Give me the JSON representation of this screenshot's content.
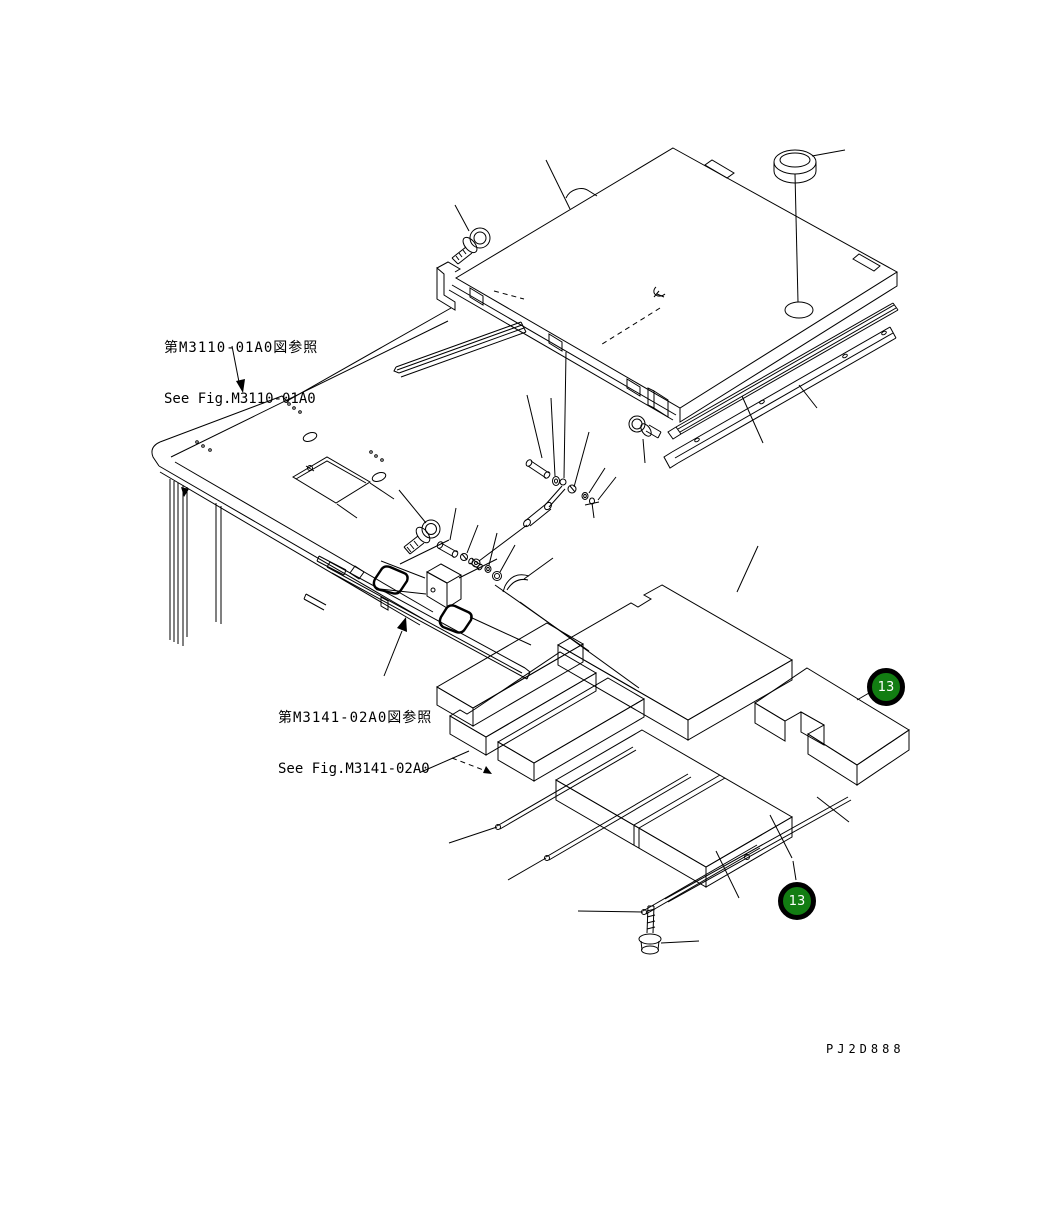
{
  "figure_references": [
    {
      "jp": "第M3110-01A0図参照",
      "en": "See Fig.M3110-01A0"
    },
    {
      "jp": "第M3141-02A0図参照",
      "en": "See Fig.M3141-02A0"
    }
  ],
  "callouts": [
    {
      "number": "13"
    },
    {
      "number": "13"
    }
  ],
  "drawing_code": "PJ2D888",
  "colors": {
    "background": "#ffffff",
    "line": "#000000",
    "callout_fill": "#127d12",
    "callout_ring": "#000000",
    "callout_text": "#ffffff"
  },
  "parts_illustrated": [
    "hood-cover-panel",
    "cap-plug",
    "hinge-blocks",
    "mounting-bolts",
    "gas-spring-damper",
    "pins-washers-clips",
    "side-rails",
    "seal-strip",
    "platform-deck",
    "deck-legs",
    "hatch-cutout",
    "support-rail-with-pads",
    "rubber-pads",
    "bracket-block",
    "floor-mat-panels",
    "mat-retainer-rods",
    "weld-stud-bolt"
  ]
}
